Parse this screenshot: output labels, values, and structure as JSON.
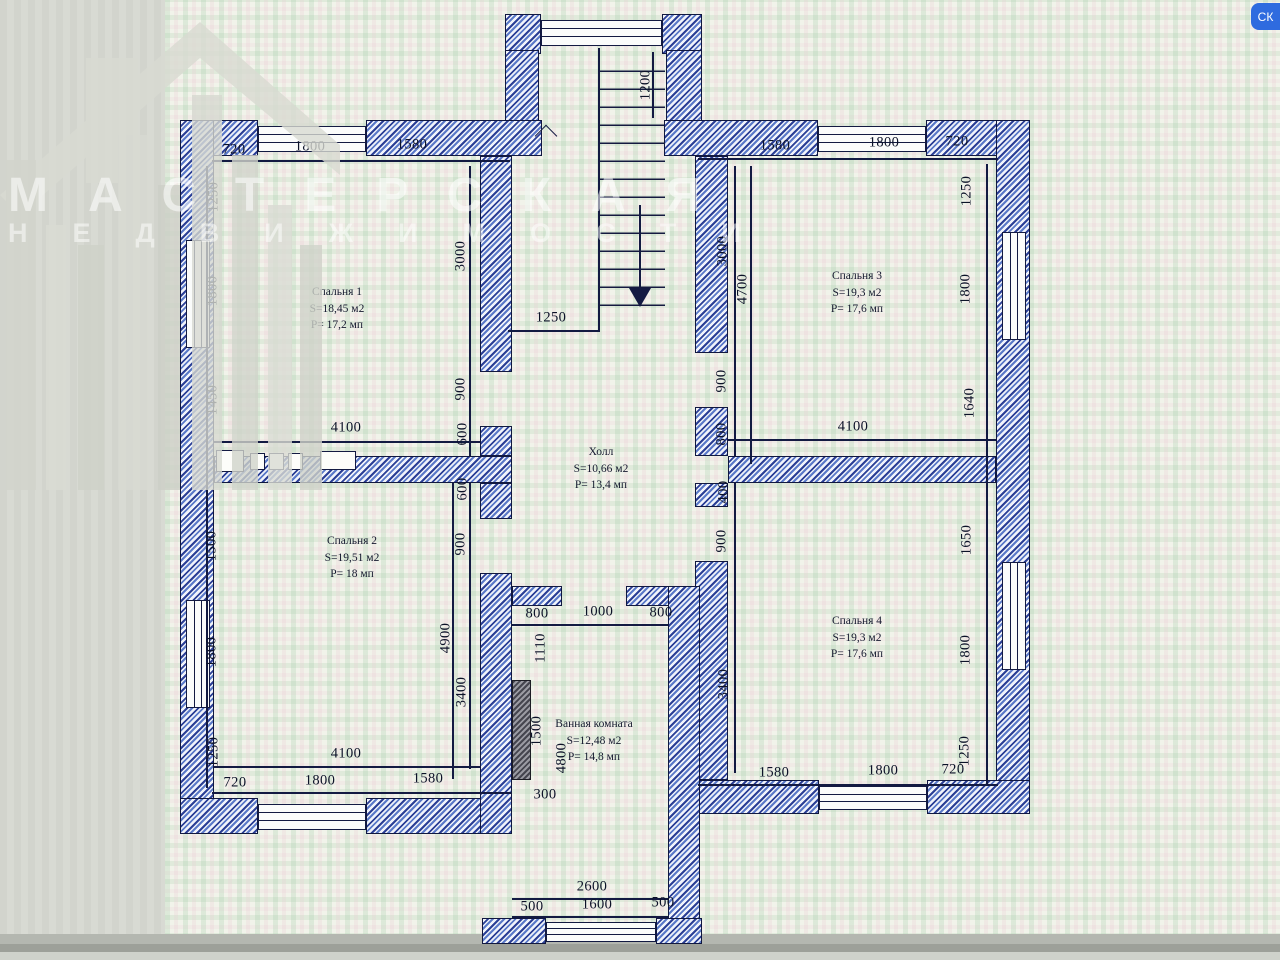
{
  "watermark": {
    "line1": "МАСТЕРСКАЯ",
    "line2": "НЕДВИЖИМОСТИ"
  },
  "corner_chip": "СК",
  "rooms": [
    {
      "name": "Спальня 1",
      "area": "S=18,45 м2",
      "perimeter": "P= 17,2 мп"
    },
    {
      "name": "Спальня 2",
      "area": "S=19,51 м2",
      "perimeter": "P= 18 мп"
    },
    {
      "name": "Спальня 3",
      "area": "S=19,3 м2",
      "perimeter": "P= 17,6 мп"
    },
    {
      "name": "Спальня 4",
      "area": "S=19,3 м2",
      "perimeter": "P= 17,6 мп"
    },
    {
      "name": "Холл",
      "area": "S=10,66 м2",
      "perimeter": "P= 13,4 мп"
    },
    {
      "name": "Ванная комната",
      "area": "S=12,48 м2",
      "perimeter": "P= 14,8 мп"
    }
  ],
  "dims": {
    "tl720": "720",
    "tl1800": "1800",
    "tl1580": "1580",
    "tr1580": "1580",
    "tr1800": "1800",
    "tr720": "720",
    "st1200": "1200",
    "st1250": "1250",
    "l1250a": "1250",
    "l1800a": "1800",
    "l1450": "1450",
    "l1500": "1500",
    "l1800b": "1800",
    "l1250b": "1250",
    "il3000": "3000",
    "il900a": "900",
    "il600a": "600",
    "il600b": "600",
    "il900b": "900",
    "il4900": "4900",
    "il3400": "3400",
    "ir3000": "3000",
    "ir4700": "4700",
    "ir900a": "900",
    "ir800": "800",
    "ir400": "400",
    "ir900b": "900",
    "ir3400": "3400",
    "r1250a": "1250",
    "r1800a": "1800",
    "r1640": "1640",
    "r1650": "1650",
    "r1800b": "1800",
    "r1250b": "1250",
    "ml4100": "4100",
    "mr4100": "4100",
    "bl4100": "4100",
    "bl720": "720",
    "bl1800": "1800",
    "bl1580": "1580",
    "br1580": "1580",
    "br1800": "1800",
    "br720": "720",
    "b800a": "800",
    "b1000": "1000",
    "b800b": "800",
    "b1110": "1110",
    "b1500": "1500",
    "b300": "300",
    "b4800": "4800",
    "b2600": "2600",
    "b500a": "500",
    "b1600": "1600",
    "b500b": "500"
  }
}
